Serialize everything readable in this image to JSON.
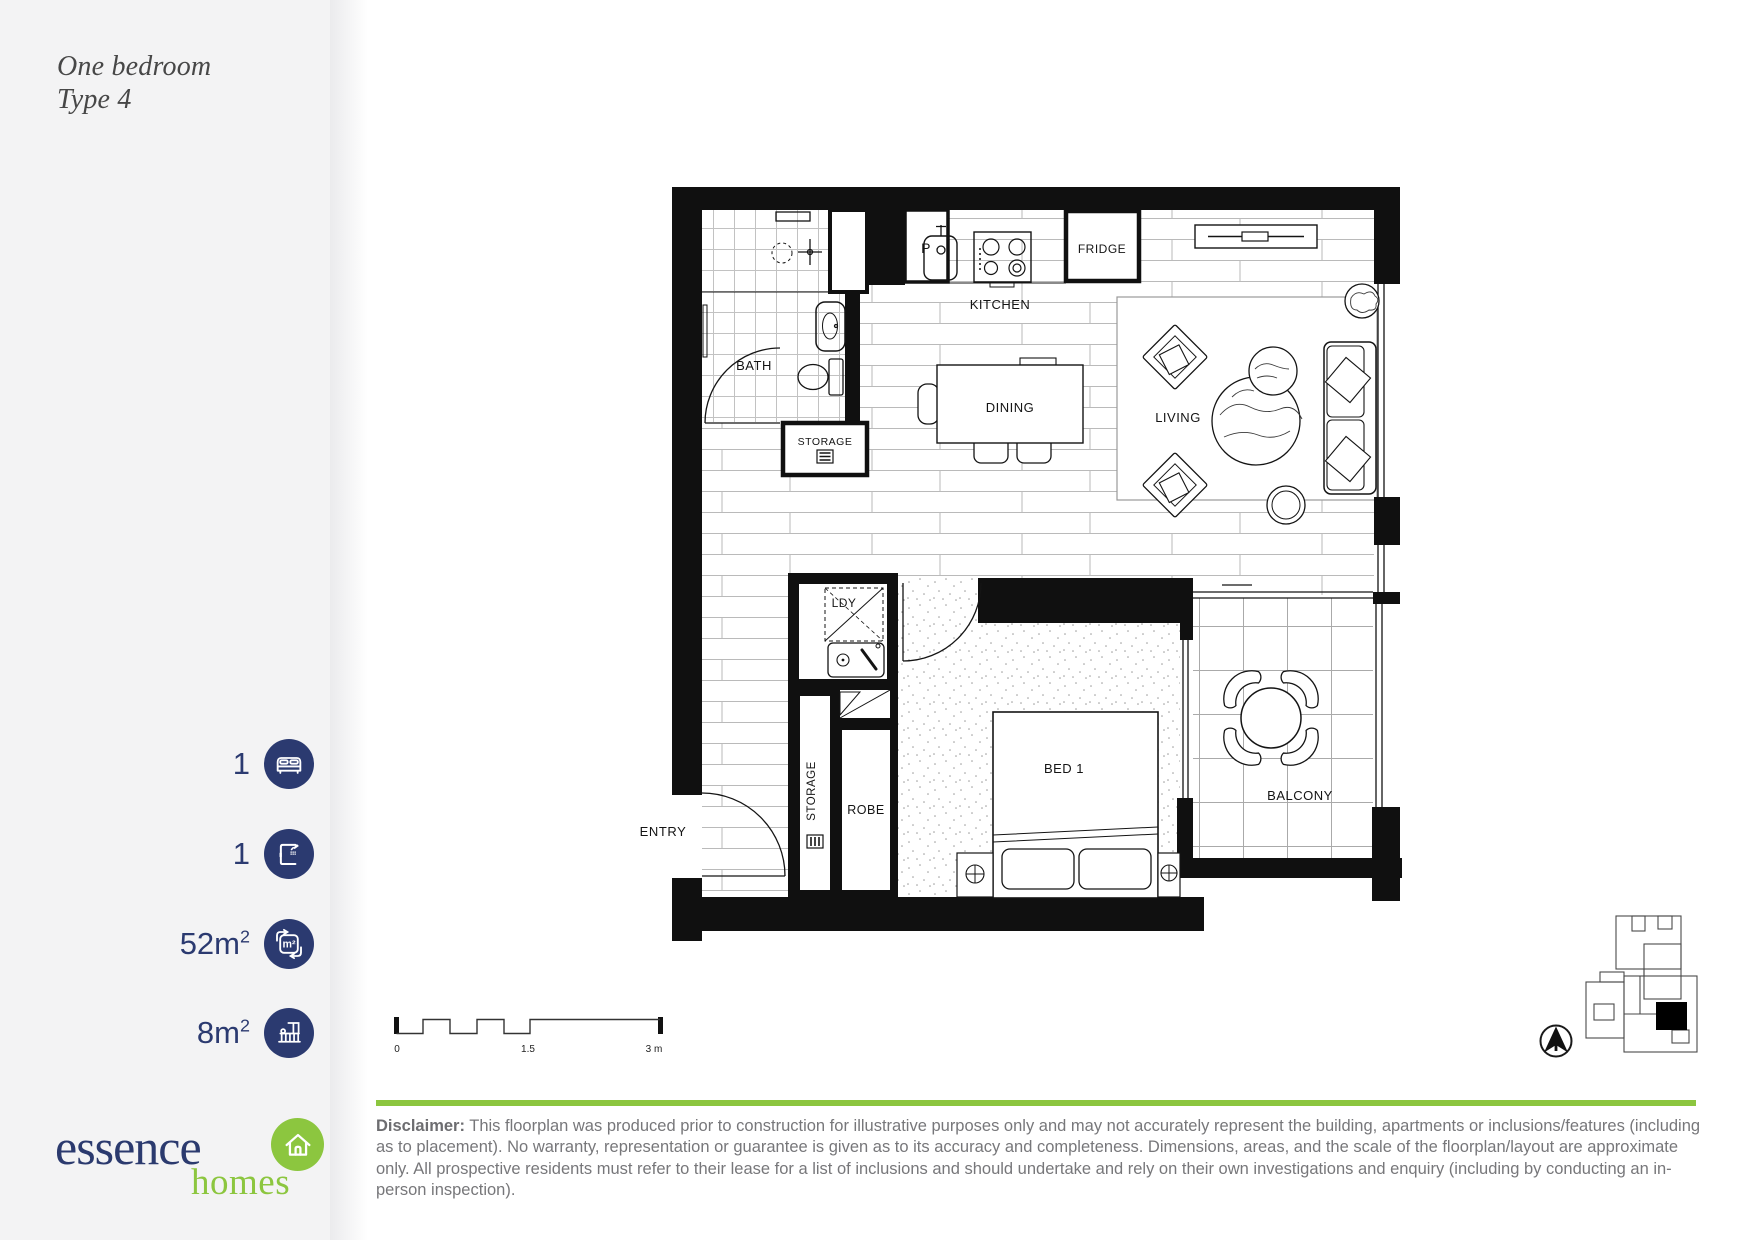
{
  "title": {
    "line1": "One bedroom",
    "line2": "Type 4"
  },
  "stats": [
    {
      "value": "1",
      "sup": "",
      "icon": "bed-icon"
    },
    {
      "value": "1",
      "sup": "",
      "icon": "shower-icon"
    },
    {
      "value": "52m",
      "sup": "2",
      "icon": "area-icon"
    },
    {
      "value": "8m",
      "sup": "2",
      "icon": "balcony-icon"
    }
  ],
  "logo": {
    "name": "essence",
    "sub": "homes"
  },
  "floorplan": {
    "labels": {
      "bath": "BATH",
      "kitchen": "KITCHEN",
      "dining": "DINING",
      "living": "LIVING",
      "fridge": "FRIDGE",
      "pantry": "P",
      "storage_upper": "STORAGE",
      "laundry": "LDY",
      "storage_lower": "STORAGE",
      "robe": "ROBE",
      "bed": "BED 1",
      "balcony": "BALCONY",
      "entry": "ENTRY"
    }
  },
  "icons": {
    "area_icon_text": "m²"
  },
  "scale_bar": {
    "start": "0",
    "mid": "1.5",
    "end": "3 m"
  },
  "disclaimer": {
    "label": "Disclaimer:",
    "text": " This floorplan was produced prior to construction for illustrative purposes only and may not accurately represent the building, apartments or inclusions/features (including as to placement). No warranty, representation or guarantee is given as to its accuracy and completeness. Dimensions, areas, and the scale of the floorplan/layout are approximate only. All prospective residents must refer to their lease for a list of inclusions and should undertake and rely on their own investigations and enquiry (including by conducting an in-person inspection)."
  },
  "colors": {
    "navy": "#2b3a70",
    "green": "#8cc63f",
    "text_gray": "#77777a",
    "sidebar_bg": "#f3f3f4"
  }
}
